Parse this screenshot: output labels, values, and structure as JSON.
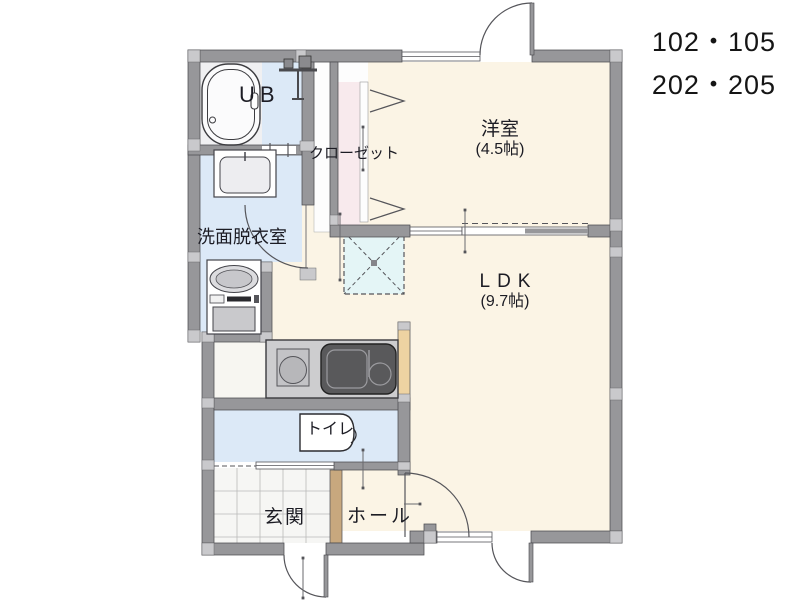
{
  "plan": {
    "units": [
      "102・105",
      "202・205"
    ],
    "rooms": {
      "western": {
        "label": "洋室",
        "size": "(4.5帖)"
      },
      "ldk": {
        "label": "LDK",
        "size": "(9.7帖)"
      },
      "washroom": {
        "label": "洗面脱衣室"
      },
      "bath": {
        "label": "UB"
      },
      "closet": {
        "label": "クローゼット"
      },
      "toilet": {
        "label": "トイレ"
      },
      "entrance": {
        "label": "玄関"
      },
      "hall": {
        "label": "ホール"
      }
    },
    "colors": {
      "wall": "#97979a",
      "wall_joint": "#c9c9cc",
      "wall_edge": "#4c4c50",
      "floor_cream": "#fbf4e5",
      "floor_blue": "#dce9f7",
      "floor_pink": "#f8eaed",
      "floor_cyan": "#e4f5f6",
      "wood_light": "#eed3a2",
      "wood_dark": "#c8a87e",
      "counter": "#cdcdcf",
      "sink": "#59595b",
      "tile_white": "#f6f6f4",
      "text_dark": "#1c1c24"
    }
  }
}
